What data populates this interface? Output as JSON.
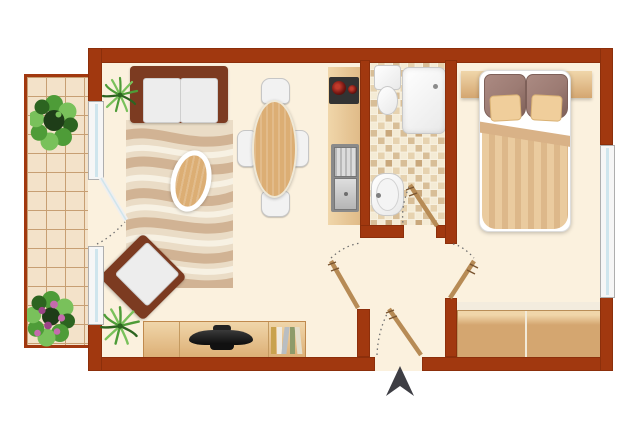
{
  "scene": {
    "type": "apartment-floor-plan-top-view",
    "width_px": 640,
    "height_px": 427,
    "text_labels": []
  },
  "colors": {
    "outside": "#ffffff",
    "wall": "#a1380f",
    "wallEdge": "#8c2f0b",
    "floor": "#fbf1de",
    "balconyTile": "#f3e2c9",
    "tileLine": "#c79f73",
    "frame": "#f6f6f6",
    "frameEdge": "#aeaeae",
    "glass": "#cfe5ed",
    "counterLight": "#f0d6aa",
    "counterDark": "#e0bb88",
    "counterEdge": "#c08a4e",
    "cooktop": "#333333",
    "burner": "#6e1410",
    "steelDark": "#8a8a8a",
    "fixtureEdge": "#c9c9c9",
    "mosaicGrout": "#f8f2e2",
    "mosaicA": "#f4ebd5",
    "mosaicB": "#e6d2af",
    "mosaicC": "#d8be97",
    "mosaicD": "#c9a87c",
    "sofa": "#7c3b21",
    "cushion": "#ededed",
    "cushionEdge": "#cfcfcf",
    "rugBase": "#eadcc6",
    "rugWave": "#d1b394",
    "rugLight": "#f7f1e3",
    "wood": "#dcae74",
    "chairWhite": "#f2f2f2",
    "chairEdge": "#c6c6c6",
    "pillowBig": "#9c7b73",
    "pillowBigEdge": "#7e6059",
    "pillowSmall": "#f0ce9b",
    "duvetA": "#eacb9f",
    "duvetB": "#ddb88a",
    "duvetFold": "#d9b287",
    "wardrobe": "#d4a670",
    "wardrobeTop": "#f3ecde",
    "doorLeaf": "#b78b55",
    "doorMark": "#7a5530",
    "arc": "#707070",
    "arrow": "#3e3e44",
    "plantGreen": "#4e9c38",
    "plantLight": "#79c15b",
    "plantDark": "#2c6420",
    "flowerPink": "#c56bad",
    "flowerDeep": "#9c4488",
    "bookColors": [
      "#c9a24e",
      "#efeae0",
      "#b9bec2",
      "#8e9b6a",
      "#e4ddc9"
    ]
  },
  "rooms": {
    "balcony": {
      "furniture": [
        "bush-plant",
        "flower-plant"
      ],
      "floor": "tiles"
    },
    "living_room": {
      "furniture": [
        "sofa",
        "zebra-rug",
        "coffee-table",
        "dining-table",
        "four-dining-chairs",
        "armchair",
        "tv-sideboard",
        "tv",
        "books",
        "palm-plant-top",
        "palm-plant-bottom"
      ],
      "floor": "cream"
    },
    "kitchenette": {
      "furniture": [
        "counter",
        "cooktop-two-burners",
        "double-sink"
      ]
    },
    "bathroom": {
      "furniture": [
        "toilet",
        "shower-tray",
        "washbasin"
      ],
      "floor": "mosaic-tiles"
    },
    "hallway": {
      "furniture": []
    },
    "bedroom": {
      "furniture": [
        "headboard-shelf",
        "double-bed",
        "two-large-pillows",
        "two-small-pillows",
        "striped-duvet",
        "wardrobe"
      ],
      "floor": "cream"
    }
  },
  "openings": {
    "doors": [
      "balcony-glass-door",
      "living-room-door",
      "bathroom-door",
      "bedroom-door",
      "entrance-door"
    ],
    "windows": [
      "balcony-window-upper",
      "balcony-window-lower",
      "bedroom-window"
    ]
  },
  "markers": {
    "entrance_arrow": "north-entrance-arrow"
  }
}
